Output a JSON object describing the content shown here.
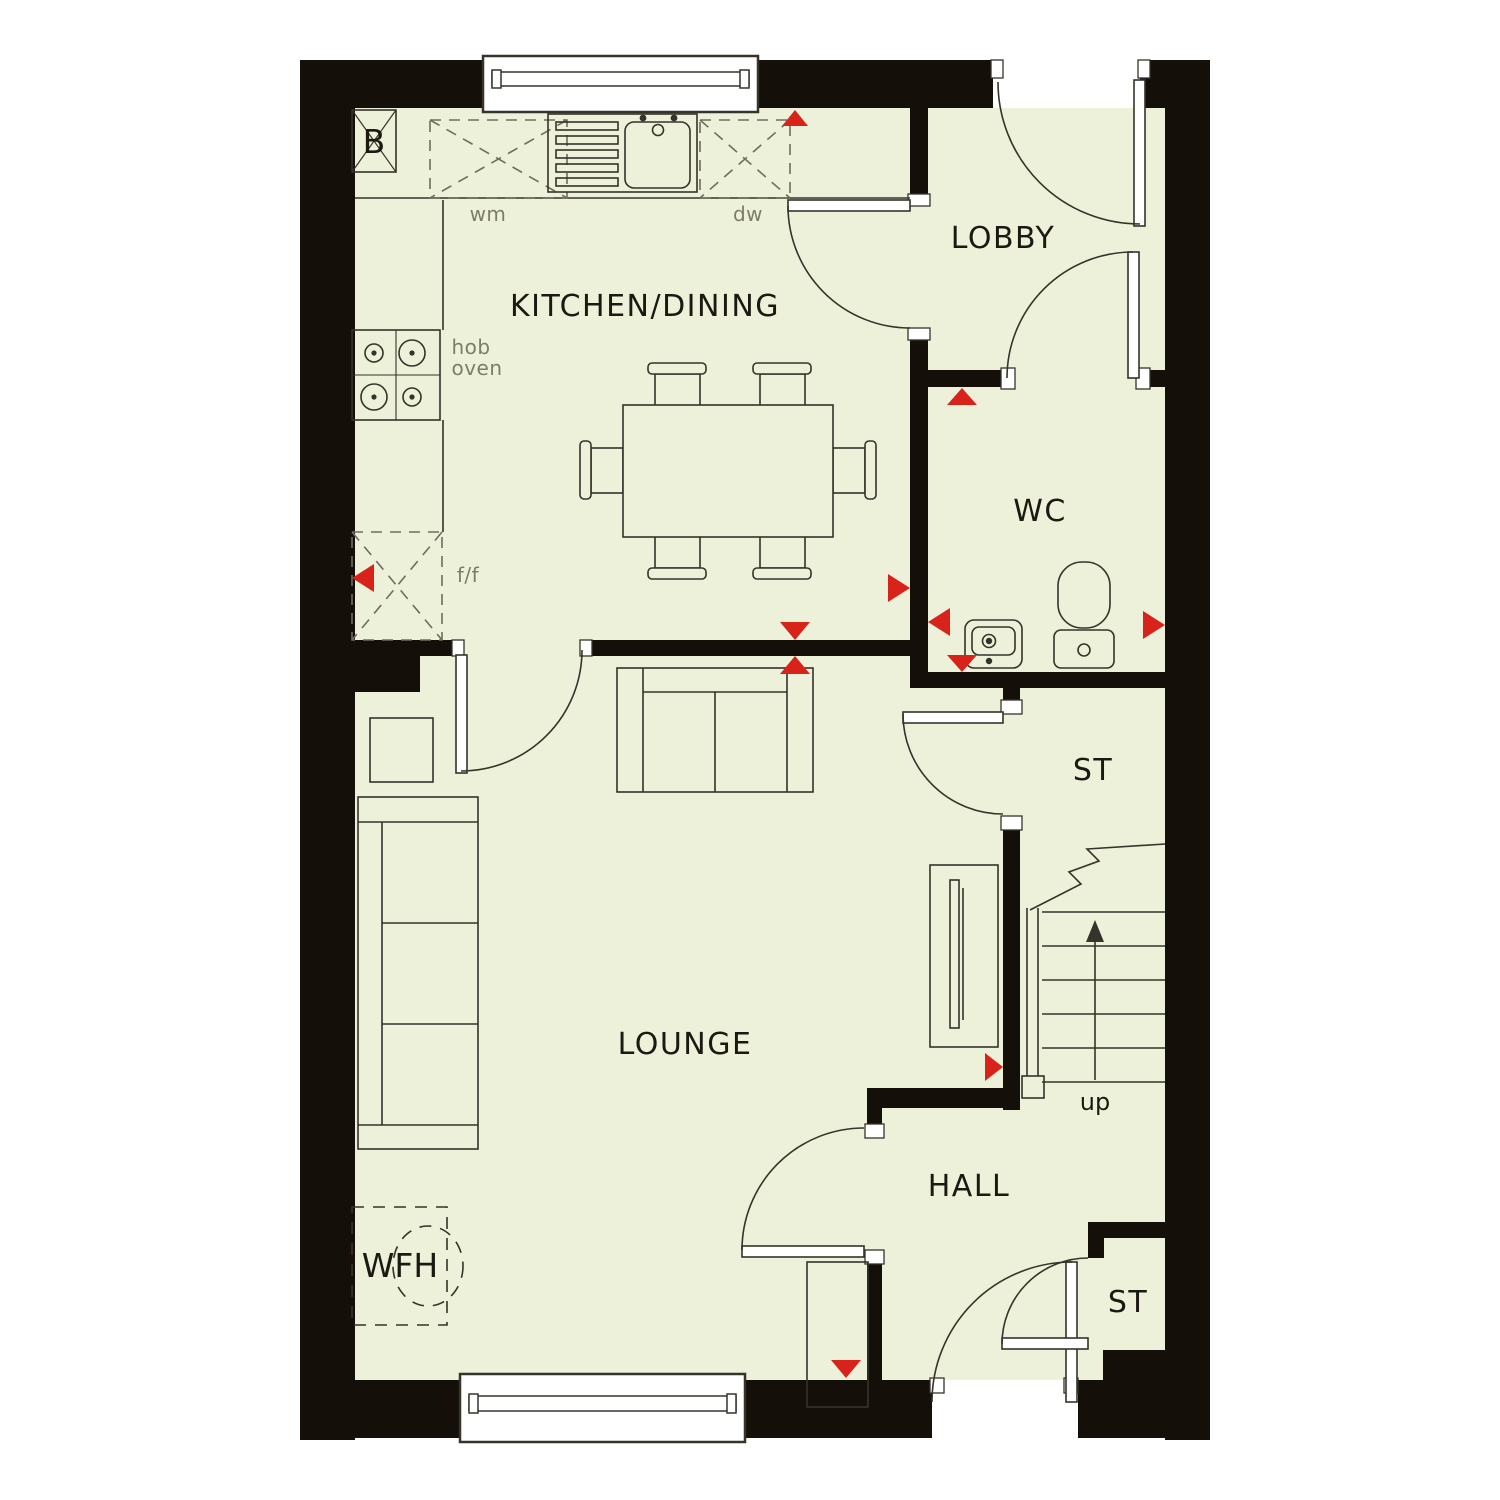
{
  "plan": {
    "type": "ground-floor-plan",
    "colors": {
      "floor": "#eef1d9",
      "wall": "#140f08",
      "line": "#35332a",
      "muted_line": "#6e6d5e",
      "muted_text": "#7d7c6a",
      "text": "#1c1912",
      "marker_red": "#d7231a",
      "outside": "#ffffff"
    },
    "rooms": [
      {
        "id": "kitchen-dining",
        "label": "KITCHEN/DINING"
      },
      {
        "id": "lobby",
        "label": "LOBBY"
      },
      {
        "id": "wc",
        "label": "WC"
      },
      {
        "id": "store-mid",
        "label": "ST"
      },
      {
        "id": "lounge",
        "label": "LOUNGE"
      },
      {
        "id": "hall",
        "label": "HALL"
      },
      {
        "id": "store-hall",
        "label": "ST"
      }
    ],
    "annotations": {
      "boiler": "B",
      "washing_machine": "wm",
      "dishwasher": "dw",
      "hob": "hob",
      "oven": "oven",
      "fridge_freezer": "f/f",
      "work_from_home": "WFH",
      "stairs_up": "up"
    },
    "fixtures": [
      "boiler-cupboard",
      "washing-machine",
      "sink-drainer",
      "dishwasher",
      "hob",
      "fridge-freezer",
      "dining-table-6-chairs",
      "sofa-2-seat",
      "sofa-3-seat",
      "side-table",
      "tv-unit",
      "wfh-desk-chair",
      "wc-basin",
      "wc-toilet",
      "staircase"
    ],
    "marker_count": 11,
    "window_count": 2,
    "door_count": 8
  }
}
